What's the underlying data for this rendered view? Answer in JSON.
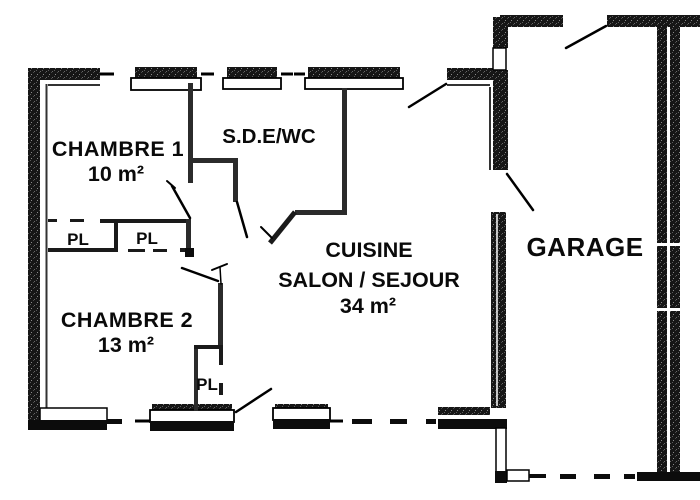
{
  "plan": {
    "title": "floor-plan",
    "rooms": {
      "chambre1": {
        "name": "CHAMBRE 1",
        "area": "10 m²"
      },
      "sde": {
        "name": "S.D.E/WC"
      },
      "chambre2": {
        "name": "CHAMBRE 2",
        "area": "13 m²"
      },
      "salon": {
        "line1": "CUISINE",
        "line2": "SALON / SEJOUR",
        "area": "34 m²"
      },
      "garage": {
        "name": "GARAGE"
      }
    },
    "closets": {
      "pl1": "PL",
      "pl2": "PL",
      "pl3": "PL"
    },
    "colors": {
      "wall": "#161616",
      "interior_wall": "#2b2b2b",
      "line": "#000000",
      "background": "#ffffff"
    }
  }
}
